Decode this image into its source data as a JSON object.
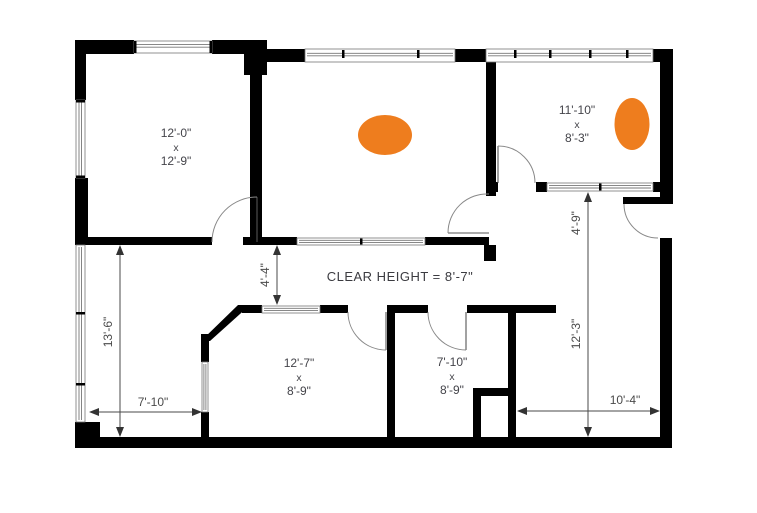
{
  "annotations": {
    "clear_height": "CLEAR HEIGHT = 8'-7\""
  },
  "rooms": [
    {
      "name": "top-left-room",
      "dims": [
        "12'-0\"",
        "x",
        "12'-9\""
      ]
    },
    {
      "name": "top-right-room",
      "dims": [
        "11'-10\"",
        "x",
        "8'-3\""
      ]
    },
    {
      "name": "bottom-middle-room",
      "dims": [
        "12'-7\"",
        "x",
        "8'-9\""
      ]
    },
    {
      "name": "bottom-right-room",
      "dims": [
        "7'-10\"",
        "x",
        "8'-9\""
      ]
    }
  ],
  "dimensions": [
    {
      "name": "left-room-height",
      "label": "13'-6\"",
      "orientation": "vertical"
    },
    {
      "name": "left-room-width",
      "label": "7'-10\"",
      "orientation": "horizontal"
    },
    {
      "name": "corridor-width",
      "label": "4'-4\"",
      "orientation": "vertical"
    },
    {
      "name": "right-upper-depth",
      "label": "4'-9\"",
      "orientation": "vertical"
    },
    {
      "name": "right-lower-depth",
      "label": "12'-3\"",
      "orientation": "vertical"
    },
    {
      "name": "bottom-right-width",
      "label": "10'-4\"",
      "orientation": "horizontal"
    }
  ],
  "markers": [
    {
      "name": "orange-marker-center-room",
      "color": "#EE7D1E"
    },
    {
      "name": "orange-marker-right-room",
      "color": "#EE7D1E"
    }
  ],
  "colors": {
    "wall": "#000000",
    "text": "#44444a",
    "dimension": "#4a4a4a",
    "background": "#ffffff"
  }
}
